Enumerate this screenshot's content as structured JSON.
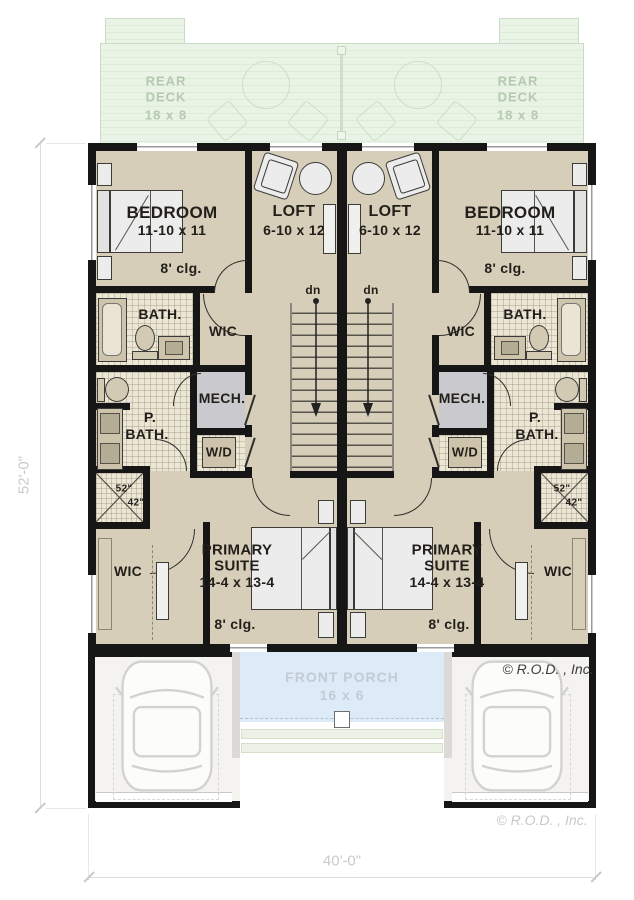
{
  "deck": {
    "name": "REAR DECK",
    "line1": "REAR",
    "line2": "DECK",
    "size": "18 x 8"
  },
  "rooms": {
    "bedroom": {
      "name": "BEDROOM",
      "size": "11-10 x 11",
      "ceiling": "8' clg."
    },
    "loft": {
      "name": "LOFT",
      "size": "6-10 x 12"
    },
    "bath": {
      "name": "BATH."
    },
    "wic": {
      "name": "WIC"
    },
    "mech": {
      "name": "MECH."
    },
    "primary_bath": {
      "name_line1": "P.",
      "name_line2": "BATH."
    },
    "laundry": {
      "name": "W/D"
    },
    "shower": {
      "width": "52\"",
      "depth": "42\""
    },
    "primary_suite": {
      "name_line1": "PRIMARY",
      "name_line2": "SUITE",
      "size": "14-4 x 13-4",
      "ceiling": "8' clg."
    }
  },
  "stairs": {
    "direction": "dn"
  },
  "porch": {
    "name": "FRONT PORCH",
    "size": "16 x 6"
  },
  "dimensions": {
    "side": "52'-0\"",
    "bottom": "40'-0\""
  },
  "copyright": {
    "plan_credit": "© R.O.D. , Inc.",
    "outer_credit": "© R.O.D. , Inc."
  },
  "colors": {
    "wall": "#161616",
    "floor": "#d7ceb9",
    "tile": "#ece6d5",
    "mech": "#c9c9ce",
    "deck": "#eaf4e6",
    "porch": "#dcebf7",
    "dimension_text": "#c9c9c9"
  }
}
